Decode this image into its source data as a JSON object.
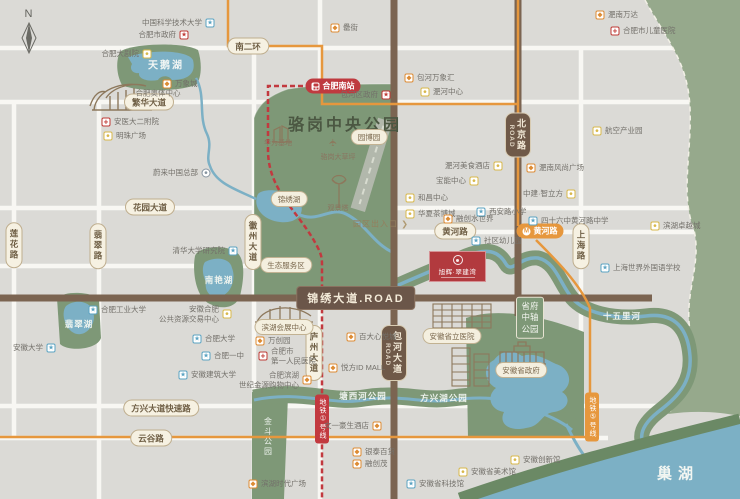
{
  "compass": {
    "label": "N"
  },
  "project": {
    "name": "旭辉·翠建湾"
  },
  "icons": {
    "edu": "★",
    "hosp": "+",
    "gov": "★",
    "mall": "◆",
    "culture": "●",
    "car": "●",
    "metro": "M",
    "chevron": "❯",
    "plane": "✈"
  },
  "colors": {
    "background": "#dbdad6",
    "park": "#7e9877",
    "east_green": "#96a98c",
    "water": "#7cb0c5",
    "road_brown": "#7b6451",
    "metro_red": "#c2393f",
    "metro_orange": "#e6973d",
    "project_red": "#b23a3e",
    "badge_beige": "#f6f1e2"
  },
  "metro": {
    "south_station": {
      "label": "合肥南站"
    },
    "huanghe_station": {
      "label": "黄河路"
    }
  },
  "road_badges": [
    {
      "name": "nan-er-huan",
      "label": "南二环",
      "x": 248,
      "y": 46,
      "style": "beige"
    },
    {
      "name": "fanhua-avenue",
      "label": "繁华大道",
      "x": 149,
      "y": 102,
      "style": "beige"
    },
    {
      "name": "huayuan-avenue",
      "label": "花园大道",
      "x": 150,
      "y": 207,
      "style": "beige"
    },
    {
      "name": "huanghe-road",
      "label": "黄河路",
      "x": 455,
      "y": 231,
      "style": "beige"
    },
    {
      "name": "fangxing-expressway",
      "label": "方兴大道快速路",
      "x": 161,
      "y": 408,
      "style": "beige"
    },
    {
      "name": "yungu-road",
      "label": "云谷路",
      "x": 151,
      "y": 438,
      "style": "beige"
    },
    {
      "name": "feicui-road",
      "label": "翡翠路",
      "x": 98,
      "y": 246,
      "style": "beige-v"
    },
    {
      "name": "lianhua-road",
      "label": "莲花路",
      "x": 14,
      "y": 245,
      "style": "beige-v"
    },
    {
      "name": "huizhou-avenue",
      "label": "徽州大道",
      "x": 253,
      "y": 242,
      "style": "beige-v"
    },
    {
      "name": "luzhou-avenue",
      "label": "庐州大道",
      "x": 314,
      "y": 353,
      "style": "beige-v"
    },
    {
      "name": "shanghai-road",
      "label": "上海路",
      "x": 581,
      "y": 246,
      "style": "beige-v"
    },
    {
      "name": "beijing-road",
      "label": "北京路",
      "sub": "ROAD",
      "x": 518,
      "y": 135,
      "style": "brown-v"
    },
    {
      "name": "baohe-avenue",
      "label": "包河大道",
      "sub": "ROAD",
      "x": 394,
      "y": 353,
      "style": "brown-v"
    },
    {
      "name": "jinxiu-avenue",
      "label": "锦绣大道.ROAD",
      "x": 356,
      "y": 298,
      "style": "brown-big"
    }
  ],
  "metro_badges": [
    {
      "name": "metro-line1-badge",
      "label": "地铁①号线",
      "x": 322,
      "y": 419,
      "style": "metro-red-v"
    },
    {
      "name": "metro-line5-badge",
      "label": "地铁⑤号线",
      "x": 592,
      "y": 417,
      "style": "metro-orange-v"
    }
  ],
  "area_labels": [
    {
      "name": "luogang-park-title",
      "label": "骆岗中央公园",
      "x": 345,
      "y": 123,
      "cls": "park-title"
    },
    {
      "name": "yuanboyuan-badge",
      "label": "园博园",
      "x": 369,
      "y": 137,
      "cls": "beige-s"
    },
    {
      "name": "jinxiu-lake-badge",
      "label": "锦绣湖",
      "x": 289,
      "y": 199,
      "cls": "beige-s"
    },
    {
      "name": "eco-service-badge",
      "label": "生态服务区",
      "x": 286,
      "y": 265,
      "cls": "beige-s"
    },
    {
      "name": "exhibition-center-badge",
      "label": "滨湖会展中心",
      "x": 284,
      "y": 327,
      "cls": "beige-s"
    },
    {
      "name": "provincial-hospital-badge",
      "label": "安徽省立医院",
      "x": 452,
      "y": 336,
      "cls": "beige-s"
    },
    {
      "name": "provincial-gov-badge",
      "label": "安徽省政府",
      "x": 521,
      "y": 370,
      "cls": "beige-s"
    },
    {
      "name": "viewing-tower-label",
      "label": "观景塔",
      "x": 338,
      "y": 208,
      "cls": "mini-brown"
    },
    {
      "name": "huawei-base-label",
      "label": "华为基地",
      "x": 278,
      "y": 143,
      "cls": "mini-brown"
    },
    {
      "name": "luogang-lawn-label",
      "label": "骆岗大草坪",
      "x": 338,
      "y": 157,
      "cls": "mini-brown"
    },
    {
      "name": "olympic-center-label",
      "label": "合肥奥体中心",
      "x": 158,
      "y": 93,
      "cls": "mini-gray"
    },
    {
      "name": "swan-lake-label",
      "label": "天鹅湖",
      "x": 166,
      "y": 64,
      "cls": "water-m"
    },
    {
      "name": "nanyan-lake-label",
      "label": "南艳湖",
      "x": 219,
      "y": 280,
      "cls": "water-s"
    },
    {
      "name": "feicui-lake-label",
      "label": "翡翠湖",
      "x": 79,
      "y": 324,
      "cls": "water-s"
    },
    {
      "name": "tangxihe-park-label",
      "label": "塘西河公园",
      "x": 363,
      "y": 396,
      "cls": "water-s"
    },
    {
      "name": "fangxinghu-park-label",
      "label": "方兴湖公园",
      "x": 444,
      "y": 398,
      "cls": "water-s"
    },
    {
      "name": "shiwuli-river-label",
      "label": "十五里河",
      "x": 622,
      "y": 316,
      "cls": "water-s"
    },
    {
      "name": "chaohu-lake-label",
      "label": "巢湖",
      "x": 678,
      "y": 473,
      "cls": "water-xl"
    },
    {
      "name": "jindou-park-label",
      "label": "金斗公园",
      "x": 268,
      "y": 437,
      "cls": "water-v"
    },
    {
      "name": "shengfu-axis-park-label",
      "label": "省府\n中轴\n公园",
      "x": 530,
      "y": 318,
      "cls": "pillar"
    }
  ],
  "entrance": {
    "label": "园区出入口"
  },
  "pois": [
    {
      "name": "ustc",
      "label": "中国科学技术大学",
      "x": 210,
      "y": 23,
      "icon": "edu",
      "side": "left"
    },
    {
      "name": "hefei-city-gov",
      "label": "合肥市政府",
      "x": 184,
      "y": 35,
      "icon": "gov",
      "side": "left"
    },
    {
      "name": "grand-theatre",
      "label": "合肥大剧院",
      "x": 147,
      "y": 54,
      "icon": "culture",
      "side": "left"
    },
    {
      "name": "mixc-mall",
      "label": "万象城",
      "x": 167,
      "y": 84,
      "icon": "mall",
      "side": "right"
    },
    {
      "name": "anyida-2-hospital",
      "label": "安医大二附院",
      "x": 106,
      "y": 122,
      "icon": "hosp",
      "side": "right"
    },
    {
      "name": "mingzhu-plaza",
      "label": "明珠广场",
      "x": 108,
      "y": 136,
      "icon": "culture",
      "side": "right"
    },
    {
      "name": "lei-street",
      "label": "罍街",
      "x": 335,
      "y": 28,
      "icon": "mall",
      "side": "right"
    },
    {
      "name": "baohe-district-gov",
      "label": "包河区政府",
      "x": 386,
      "y": 95,
      "icon": "gov",
      "side": "left"
    },
    {
      "name": "baohe-mixc",
      "label": "包河万象汇",
      "x": 409,
      "y": 78,
      "icon": "mall",
      "side": "right"
    },
    {
      "name": "feihe-center",
      "label": "淝河中心",
      "x": 425,
      "y": 92,
      "icon": "culture",
      "side": "right"
    },
    {
      "name": "feinan-wanda",
      "label": "淝南万达",
      "x": 600,
      "y": 15,
      "icon": "mall",
      "side": "right"
    },
    {
      "name": "children-hospital",
      "label": "合肥市儿童医院",
      "x": 615,
      "y": 31,
      "icon": "hosp",
      "side": "right"
    },
    {
      "name": "aviation-industry-park",
      "label": "航空产业园",
      "x": 597,
      "y": 131,
      "icon": "culture",
      "side": "right"
    },
    {
      "name": "nio-china-hq",
      "label": "蔚来中国总部",
      "x": 206,
      "y": 173,
      "icon": "car",
      "side": "left"
    },
    {
      "name": "tsinghua-institute",
      "label": "清华大学研究院",
      "x": 233,
      "y": 251,
      "icon": "edu",
      "side": "left"
    },
    {
      "name": "hfut",
      "label": "合肥工业大学",
      "x": 93,
      "y": 310,
      "icon": "edu",
      "side": "right"
    },
    {
      "name": "public-resource-center",
      "label": "安徽合肥",
      "label2": "公共资源交易中心",
      "x": 227,
      "y": 314,
      "icon": "culture",
      "side": "left"
    },
    {
      "name": "anhui-university",
      "label": "安徽大学",
      "x": 51,
      "y": 348,
      "icon": "edu",
      "side": "left"
    },
    {
      "name": "hefei-university",
      "label": "合肥大学",
      "x": 197,
      "y": 339,
      "icon": "edu",
      "side": "right"
    },
    {
      "name": "hefei-no1-school",
      "label": "合肥一中",
      "x": 206,
      "y": 356,
      "icon": "edu",
      "side": "right"
    },
    {
      "name": "anhui-jianzhu-university",
      "label": "安徽建筑大学",
      "x": 183,
      "y": 375,
      "icon": "edu",
      "side": "right"
    },
    {
      "name": "meishi-hotel",
      "label": "淝河美食酒店",
      "x": 498,
      "y": 166,
      "icon": "culture",
      "side": "left"
    },
    {
      "name": "baoneng-center",
      "label": "宝能中心",
      "x": 474,
      "y": 181,
      "icon": "culture",
      "side": "left"
    },
    {
      "name": "hechang-center",
      "label": "和昌中心",
      "x": 410,
      "y": 198,
      "icon": "culture",
      "side": "right"
    },
    {
      "name": "huaxia-tea-city",
      "label": "华夏茶博城",
      "x": 410,
      "y": 214,
      "icon": "culture",
      "side": "right"
    },
    {
      "name": "water-world",
      "label": "融创水世界",
      "x": 448,
      "y": 219,
      "icon": "mall",
      "side": "right"
    },
    {
      "name": "xian-road-primary",
      "label": "西安路小学",
      "x": 481,
      "y": 212,
      "icon": "edu",
      "side": "right"
    },
    {
      "name": "no46-huanghe-middle",
      "label": "四十六中黄河路中学",
      "x": 533,
      "y": 221,
      "icon": "edu",
      "side": "right"
    },
    {
      "name": "community-kindergarten",
      "label": "社区幼儿园",
      "x": 476,
      "y": 241,
      "icon": "edu",
      "side": "right"
    },
    {
      "name": "feinan-fashion-plaza",
      "label": "淝南风尚广场",
      "x": 531,
      "y": 168,
      "icon": "mall",
      "side": "right"
    },
    {
      "name": "zhongjian-cube",
      "label": "中建·智立方",
      "x": 571,
      "y": 194,
      "icon": "culture",
      "side": "left"
    },
    {
      "name": "binhu-zhuoyue-city",
      "label": "滨湖卓越城",
      "x": 655,
      "y": 226,
      "icon": "culture",
      "side": "right"
    },
    {
      "name": "shanghai-foreign-school",
      "label": "上海世界外国语学校",
      "x": 605,
      "y": 268,
      "icon": "edu",
      "side": "right"
    },
    {
      "name": "wanchuang-park",
      "label": "万创园",
      "x": 260,
      "y": 341,
      "icon": "mall",
      "side": "right"
    },
    {
      "name": "first-people-hospital",
      "label": "合肥市",
      "label2": "第一人民医院",
      "x": 263,
      "y": 356,
      "icon": "hosp",
      "side": "right"
    },
    {
      "name": "jinyuan-shopping-center",
      "label": "合肥滨湖",
      "label2": "世纪金源购物中心",
      "x": 307,
      "y": 380,
      "icon": "mall",
      "side": "left"
    },
    {
      "name": "yuefang-id-mall",
      "label": "悦方ID MALL",
      "x": 333,
      "y": 368,
      "icon": "mall",
      "side": "right"
    },
    {
      "name": "baida-xinyue-city",
      "label": "百大心悦城",
      "x": 351,
      "y": 337,
      "icon": "mall",
      "side": "right"
    },
    {
      "name": "wenyi-hotel",
      "label": "文一豪生酒店",
      "x": 377,
      "y": 426,
      "icon": "mall",
      "side": "left"
    },
    {
      "name": "yintai-department",
      "label": "银泰百货",
      "x": 357,
      "y": 452,
      "icon": "mall",
      "side": "right"
    },
    {
      "name": "rongchuang-mao",
      "label": "融创茂",
      "x": 357,
      "y": 464,
      "icon": "mall",
      "side": "right"
    },
    {
      "name": "binhu-times-plaza",
      "label": "滨湖时代广场",
      "x": 253,
      "y": 484,
      "icon": "mall",
      "side": "right"
    },
    {
      "name": "science-museum",
      "label": "安徽省科技馆",
      "x": 411,
      "y": 484,
      "icon": "edu",
      "side": "right"
    },
    {
      "name": "art-museum",
      "label": "安徽省美术馆",
      "x": 463,
      "y": 472,
      "icon": "culture",
      "side": "right"
    },
    {
      "name": "innovation-hall",
      "label": "安徽创新馆",
      "x": 515,
      "y": 460,
      "icon": "culture",
      "side": "right"
    }
  ]
}
